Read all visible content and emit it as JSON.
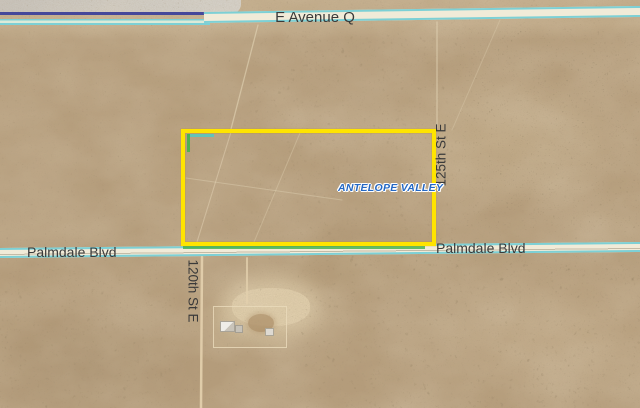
{
  "labels": {
    "avenue_q": "E Avenue Q",
    "palmdale_blvd_left": "Palmdale Blvd",
    "palmdale_blvd_right": "Palmdale Blvd",
    "street_120th": "120th St E",
    "street_125th": "125th St E",
    "watermark": "ANTELOPE VALLEY"
  },
  "colors": {
    "parcel_highlight": "#ffe400",
    "parcel_accent_green": "#44b34c",
    "parcel_accent_teal": "#59c6c0",
    "road_casing": "#7dd0d5",
    "road_fill": "#f1ebd8",
    "railway_line": "#45489a",
    "paved_area": "#cbc7c1",
    "watermark_text": "#2468c4",
    "street_label_text": "#3a3a3a",
    "desert_base": "#b59c7a"
  }
}
